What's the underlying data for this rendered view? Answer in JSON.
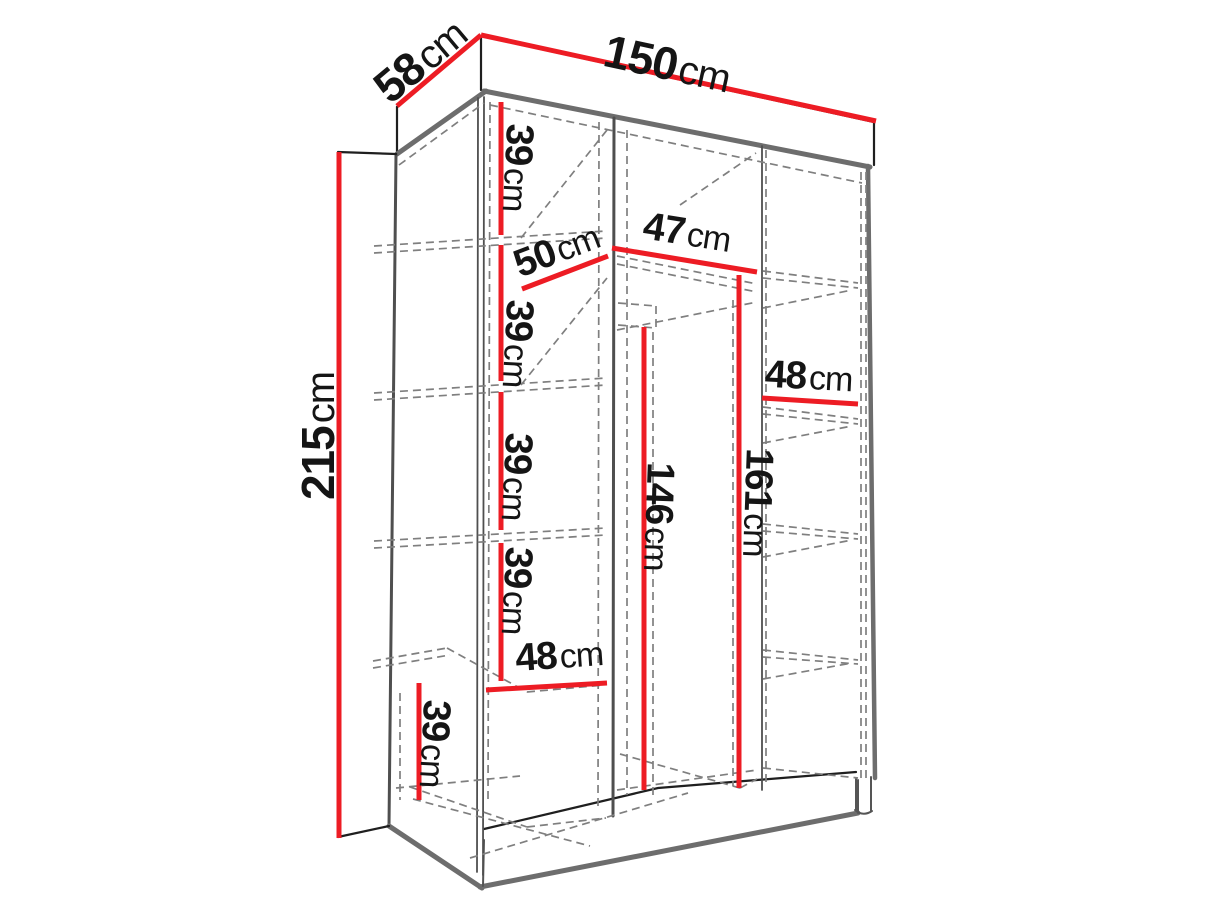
{
  "diagram": {
    "type": "furniture-dimension-diagram",
    "subject": "three-section wardrobe with shelves, perspective line drawing",
    "unit": "cm",
    "accent_color": "#ed1c24",
    "label_color": "#151515",
    "labels": [
      {
        "id": "depth-top",
        "num": "58",
        "unit": "cm"
      },
      {
        "id": "width-top",
        "num": "150",
        "unit": "cm"
      },
      {
        "id": "height-overall",
        "num": "215",
        "unit": "cm"
      },
      {
        "id": "left-shelf-gap-1",
        "num": "39",
        "unit": "cm"
      },
      {
        "id": "left-column-width",
        "num": "50",
        "unit": "cm"
      },
      {
        "id": "middle-column-width",
        "num": "47",
        "unit": "cm"
      },
      {
        "id": "left-shelf-gap-2",
        "num": "39",
        "unit": "cm"
      },
      {
        "id": "right-column-width",
        "num": "48",
        "unit": "cm"
      },
      {
        "id": "left-shelf-gap-3",
        "num": "39",
        "unit": "cm"
      },
      {
        "id": "middle-rod-height",
        "num": "146",
        "unit": "cm"
      },
      {
        "id": "middle-space-height",
        "num": "161",
        "unit": "cm"
      },
      {
        "id": "left-shelf-gap-4",
        "num": "39",
        "unit": "cm"
      },
      {
        "id": "left-bottom-width",
        "num": "48",
        "unit": "cm"
      },
      {
        "id": "left-shelf-gap-5",
        "num": "39",
        "unit": "cm"
      }
    ]
  }
}
